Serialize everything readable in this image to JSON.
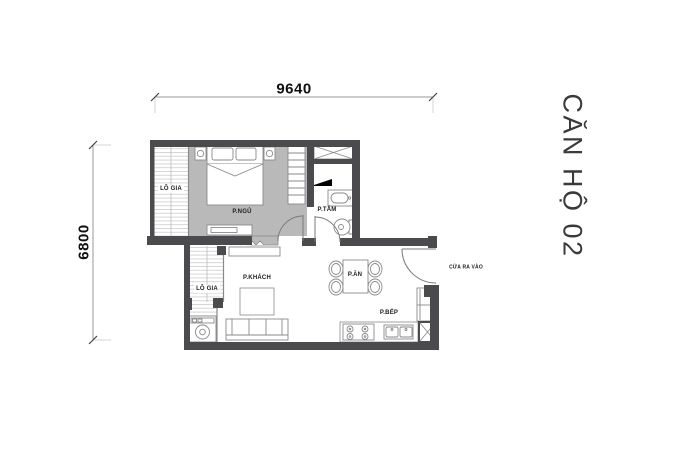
{
  "unit_title": "CĂN HỘ 02",
  "dimensions": {
    "width": "9640",
    "height": "6800"
  },
  "labels": {
    "loggia_top": "LÔ GIA",
    "bedroom": "P.NGỦ",
    "bathroom": "P.TẮM",
    "living_room": "P.KHÁCH",
    "dining": "P.ĂN",
    "kitchen": "P.BẾP",
    "loggia_bottom": "LÔ GIA",
    "entrance": "CỬA RA VÀO"
  },
  "colors": {
    "wall": "#4b4b4d",
    "bedroom_floor": "#b9b9b9",
    "furniture_line": "#8a8a8a",
    "hatch_line": "#cdcdcd",
    "dimension_line": "#9a9a9a",
    "label_text": "#1c1c1c",
    "title_text": "#3a3a3a",
    "background": "#ffffff"
  }
}
